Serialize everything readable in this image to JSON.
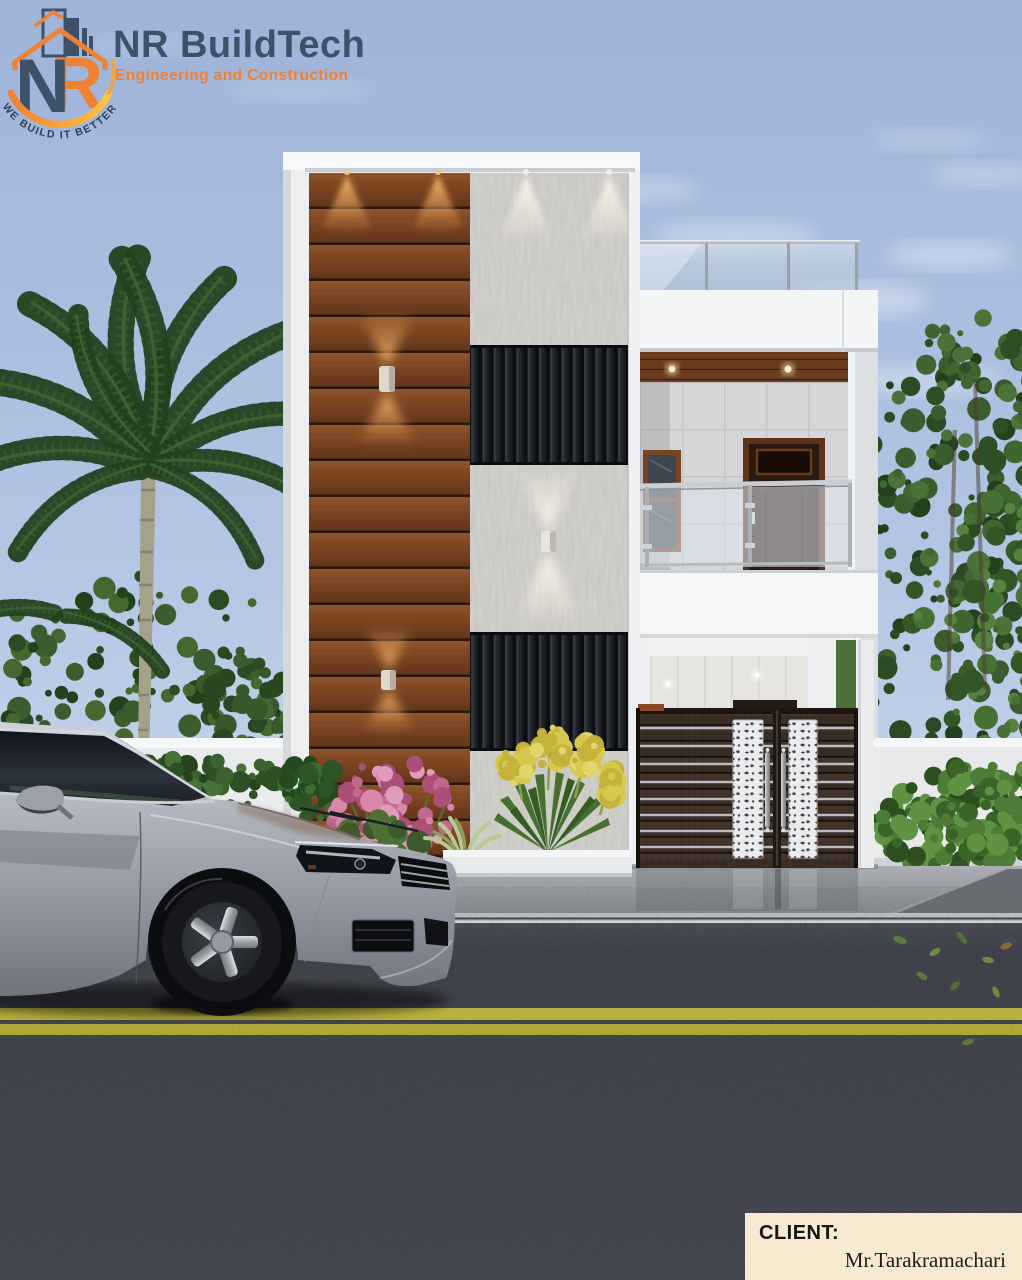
{
  "branding": {
    "company_name": "NR BuildTech",
    "tagline": "Engineering and Construction",
    "motto": "WE BUILD IT BETTER",
    "emblem": {
      "letter_n": "N",
      "letter_r": "R"
    },
    "colors": {
      "navy": "#3d5269",
      "orange": "#f08132",
      "arc_yellow": "#ffc63f"
    }
  },
  "client": {
    "label": "CLIENT:",
    "name": "Mr.Tarakramachari"
  },
  "palette": {
    "sky_top": "#9db3d8",
    "sky_bottom": "#dee7f3",
    "wood_panel": "#7a4421",
    "stone_panel": "#d6d4cf",
    "louver_dark": "#15171b",
    "facade_white": "#f1f3f5",
    "gate_wood": "#3a2d24",
    "hedge_green": "#4c7c35",
    "road_asphalt": "#383a42",
    "lane_yellow": "#c3bd3b",
    "pavement_gray": "#a8abb0",
    "car_silver": "#b3b8c1",
    "client_box_bg": "#f8e9d1"
  }
}
